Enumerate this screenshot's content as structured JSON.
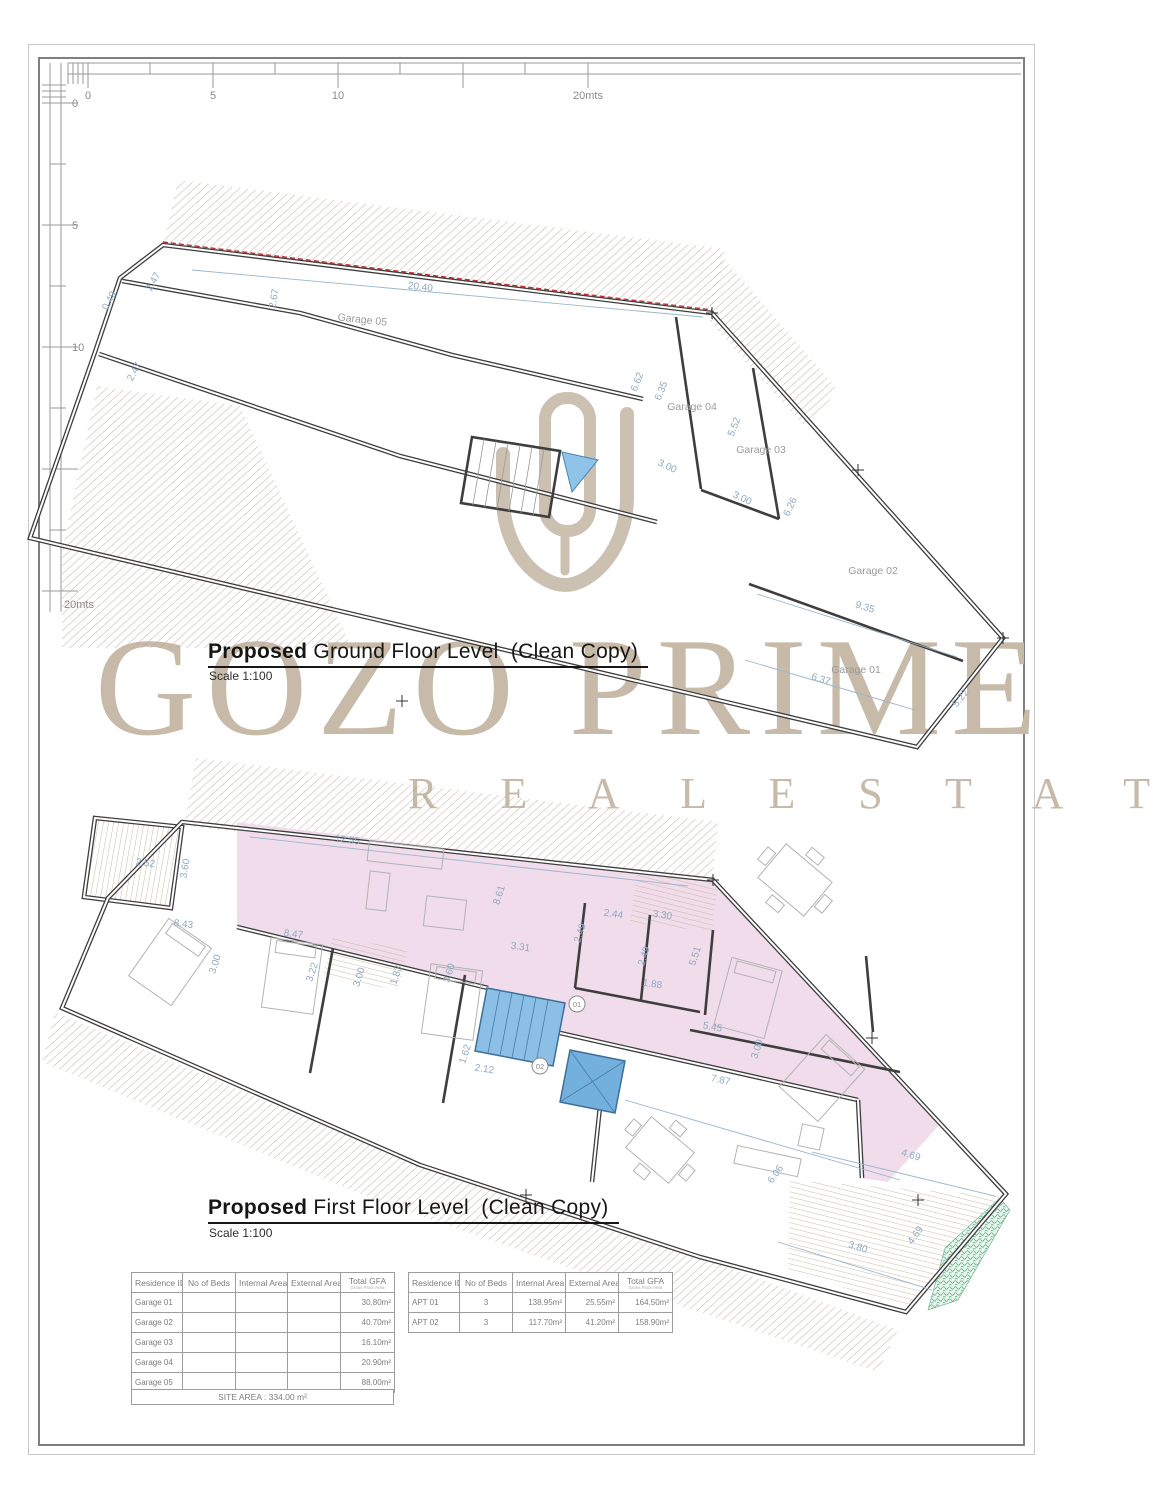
{
  "page": {
    "watermark_line1": "GOZO PRIME",
    "watermark_line2": "R E A L   E S T A T E"
  },
  "rulers": {
    "horizontal_labels": [
      "0",
      "5",
      "10",
      "20mts"
    ],
    "vertical_labels": [
      "0",
      "5",
      "10",
      "20mts"
    ]
  },
  "ground_floor": {
    "title_bold": "Proposed",
    "title_rest": " Ground Floor Level  (Clean Copy)",
    "scale_label": "Scale 1:100",
    "room_labels": [
      "Garage 05",
      "Garage 04",
      "Garage 03",
      "Garage 02",
      "Garage 01"
    ],
    "dims": [
      "0.49",
      "2.47",
      "2.67",
      "20.40",
      "2.47",
      "6.62",
      "6.35",
      "5.52",
      "3.00",
      "3.00",
      "6.26",
      "9.35",
      "6.37",
      "5.22"
    ]
  },
  "first_floor": {
    "title_bold": "Proposed",
    "title_rest": " First Floor Level  (Clean Copy)",
    "scale_label": "Scale 1:100",
    "unit_markers": [
      "01",
      "02"
    ],
    "dims": [
      "2.52",
      "3.60",
      "12.55",
      "8.43",
      "8.47",
      "3.00",
      "3.22",
      "3.00",
      "8.61",
      "2.44",
      "2.49",
      "3.31",
      "3.30",
      "2.49",
      "5.51",
      "1.88",
      "5.45",
      "3.00",
      "7.87",
      "1.62",
      "2.12",
      "3.60",
      "6.06",
      "4.69",
      "4.69",
      "3.80",
      "1.83"
    ]
  },
  "tables": {
    "headers": [
      "Residence ID",
      "No of Beds",
      "Internal Area",
      "External Area",
      "Total GFA"
    ],
    "gfa_subnote": "Gross Floor Area",
    "garages": {
      "rows": [
        {
          "id": "Garage 01",
          "beds": "",
          "internal": "",
          "external": "",
          "gfa": "30.80m²"
        },
        {
          "id": "Garage 02",
          "beds": "",
          "internal": "",
          "external": "",
          "gfa": "40.70m²"
        },
        {
          "id": "Garage 03",
          "beds": "",
          "internal": "",
          "external": "",
          "gfa": "16.10m²"
        },
        {
          "id": "Garage 04",
          "beds": "",
          "internal": "",
          "external": "",
          "gfa": "20.90m²"
        },
        {
          "id": "Garage 05",
          "beds": "",
          "internal": "",
          "external": "",
          "gfa": "88.00m²"
        }
      ],
      "site_area": "SITE AREA : 334.00 m²"
    },
    "apartments": {
      "rows": [
        {
          "id": "APT 01",
          "beds": "3",
          "internal": "138.95m²",
          "external": "25.55m²",
          "gfa": "164.50m²"
        },
        {
          "id": "APT 02",
          "beds": "3",
          "internal": "117.70m²",
          "external": "41.20m²",
          "gfa": "158.90m²"
        }
      ]
    }
  },
  "colors": {
    "apartment_pink": "#f0dcea",
    "stair_blue": "#8bbfe6",
    "planter_green": "#5cb383",
    "boundary_red": "#c03030",
    "dimension_blue": "#8fa9c2",
    "wall_dark": "#3e3e3e",
    "watermark_taupe": "#c7baa9"
  }
}
